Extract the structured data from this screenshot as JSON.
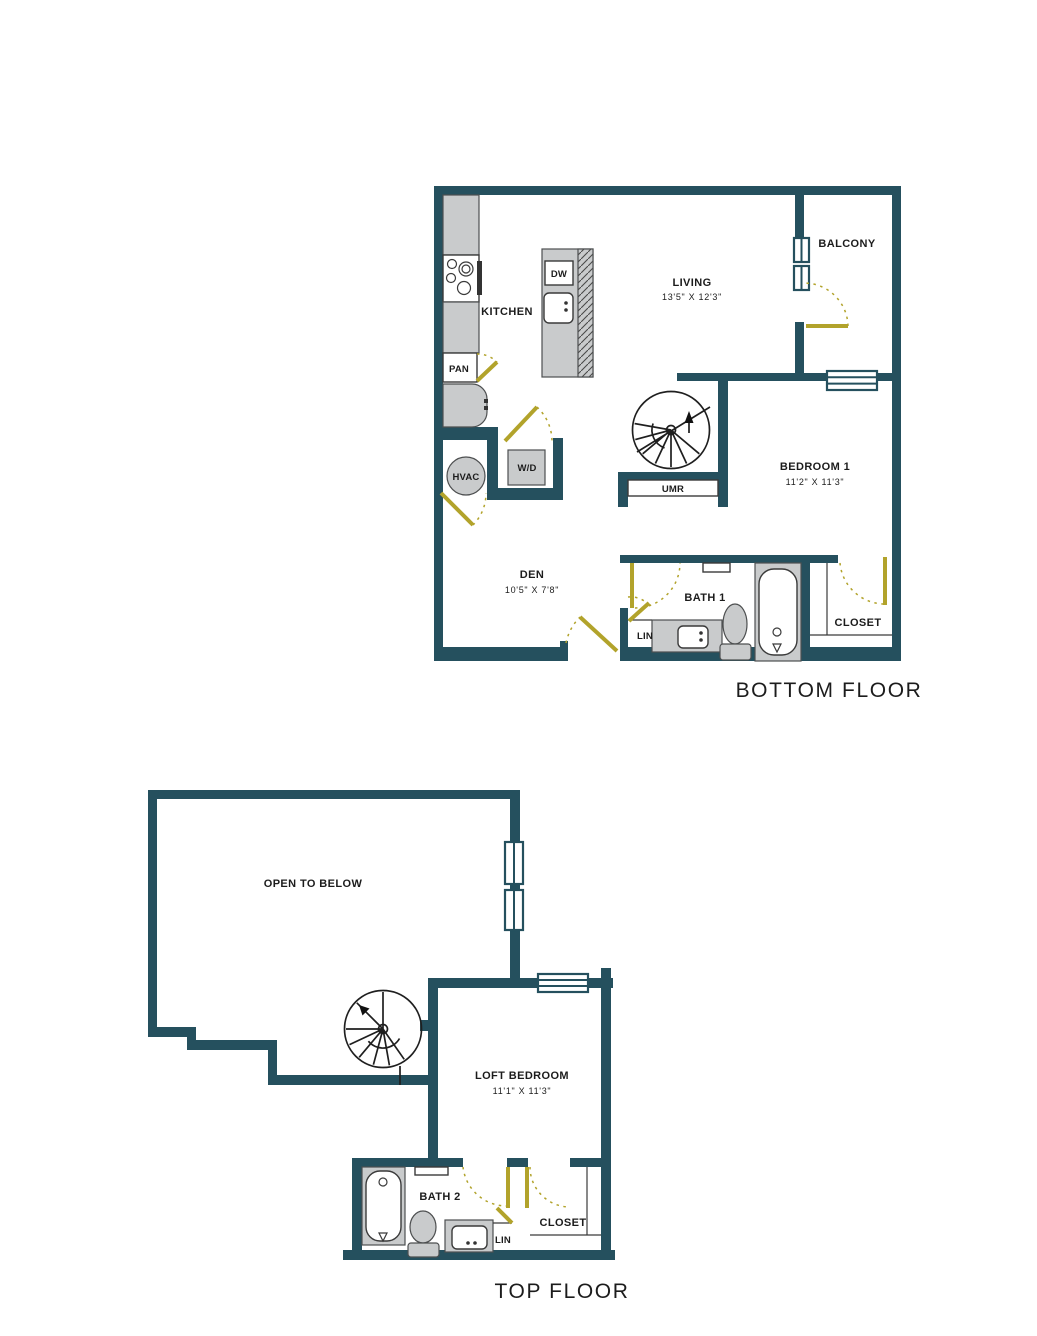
{
  "palette": {
    "wall": "#25505e",
    "door_accent": "#b2a32b",
    "fixture_fill": "#c9cbcc",
    "text": "#1c1c1c"
  },
  "bottom": {
    "title": "BOTTOM FLOOR",
    "kitchen": "KITCHEN",
    "pan": "PAN",
    "dw": "DW",
    "living": "LIVING",
    "living_dims": "13'5\" X 12'3\"",
    "balcony": "BALCONY",
    "bedroom1": "BEDROOM 1",
    "bedroom1_dims": "11'2\" X 11'3\"",
    "den": "DEN",
    "den_dims": "10'5\" X 7'8\"",
    "hvac": "HVAC",
    "wd": "W/D",
    "umr": "UMR",
    "bath1": "BATH 1",
    "lin": "LIN",
    "closet": "CLOSET"
  },
  "top": {
    "title": "TOP FLOOR",
    "open_to_below": "OPEN TO BELOW",
    "loft": "LOFT BEDROOM",
    "loft_dims": "11'1\" X 11'3\"",
    "bath2": "BATH 2",
    "lin": "LIN",
    "closet": "CLOSET"
  }
}
